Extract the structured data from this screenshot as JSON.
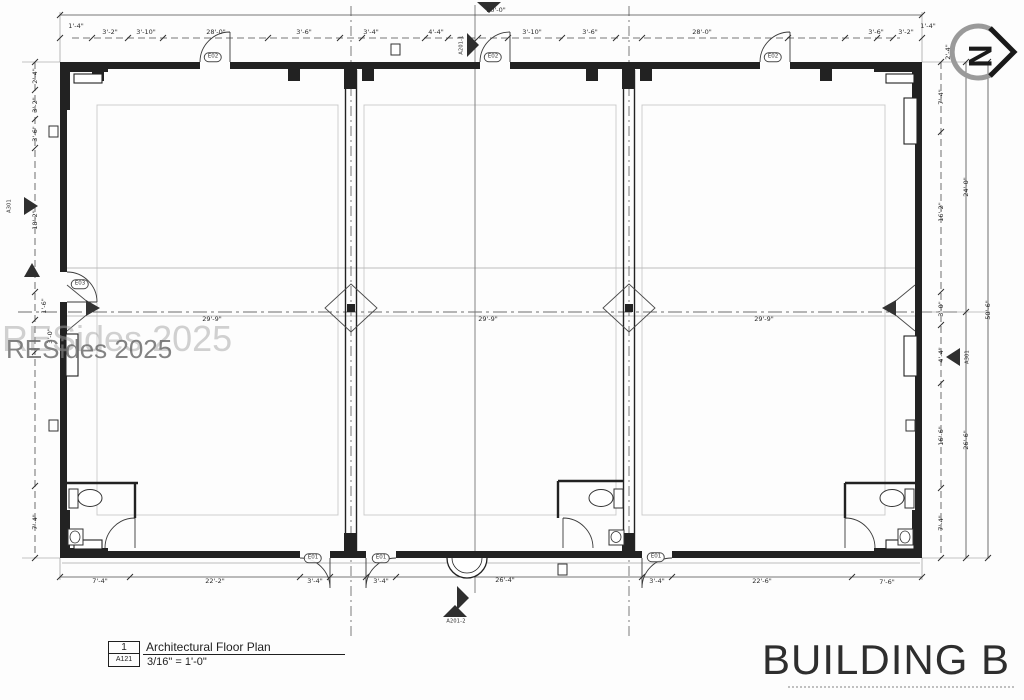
{
  "drawing": {
    "building_title": "BUILDING B",
    "watermark_text": "RESides 2025",
    "north_label": "N",
    "title_block": {
      "detail_number": "1",
      "sheet_number": "A121",
      "view_title": "Architectural Floor Plan",
      "scale": "3/16\" = 1'-0\""
    }
  },
  "labels": [
    {
      "t": "90'-0\"",
      "x": 496,
      "y": 10
    },
    {
      "t": "1'-4\"",
      "x": 76,
      "y": 26
    },
    {
      "t": "3'-2\"",
      "x": 110,
      "y": 32
    },
    {
      "t": "3'-10\"",
      "x": 146,
      "y": 32
    },
    {
      "t": "28'-0\"",
      "x": 216,
      "y": 32
    },
    {
      "t": "3'-6\"",
      "x": 304,
      "y": 32
    },
    {
      "t": "3'-4\"",
      "x": 371,
      "y": 32
    },
    {
      "t": "4'-4\"",
      "x": 436,
      "y": 32
    },
    {
      "t": "3'-10\"",
      "x": 532,
      "y": 32
    },
    {
      "t": "3'-6\"",
      "x": 590,
      "y": 32
    },
    {
      "t": "28'-0\"",
      "x": 702,
      "y": 32
    },
    {
      "t": "3'-6\"",
      "x": 876,
      "y": 32
    },
    {
      "t": "3'-2\"",
      "x": 906,
      "y": 32
    },
    {
      "t": "1'-4\"",
      "x": 928,
      "y": 26
    },
    {
      "t": "7'-4\"",
      "x": 100,
      "y": 581
    },
    {
      "t": "22'-2\"",
      "x": 215,
      "y": 581
    },
    {
      "t": "3'-4\"",
      "x": 315,
      "y": 581
    },
    {
      "t": "3'-4\"",
      "x": 381,
      "y": 581
    },
    {
      "t": "26'-4\"",
      "x": 505,
      "y": 580
    },
    {
      "t": "3'-4\"",
      "x": 657,
      "y": 581
    },
    {
      "t": "22'-6\"",
      "x": 762,
      "y": 581
    },
    {
      "t": "7'-6\"",
      "x": 887,
      "y": 582
    },
    {
      "t": "29'-9\"",
      "x": 212,
      "y": 319
    },
    {
      "t": "29'-9\"",
      "x": 488,
      "y": 319
    },
    {
      "t": "29'-9\"",
      "x": 764,
      "y": 319
    },
    {
      "t": "7'-4\"",
      "x": 941,
      "y": 97,
      "r": 1
    },
    {
      "t": "16'-2\"",
      "x": 941,
      "y": 212,
      "r": 1
    },
    {
      "t": "3'-0\"",
      "x": 941,
      "y": 309,
      "r": 1
    },
    {
      "t": "4'-4\"",
      "x": 941,
      "y": 355,
      "r": 1
    },
    {
      "t": "16'-6\"",
      "x": 941,
      "y": 436,
      "r": 1
    },
    {
      "t": "7'-4\"",
      "x": 941,
      "y": 523,
      "r": 1
    },
    {
      "t": "24'-0\"",
      "x": 966,
      "y": 187,
      "r": 1
    },
    {
      "t": "26'-6\"",
      "x": 966,
      "y": 440,
      "r": 1
    },
    {
      "t": "50'-6\"",
      "x": 988,
      "y": 310,
      "r": 1
    },
    {
      "t": "2'-4\"",
      "x": 948,
      "y": 52,
      "r": 1
    },
    {
      "t": "2'-4\"",
      "x": 35,
      "y": 76,
      "r": 1
    },
    {
      "t": "3'-2\"",
      "x": 35,
      "y": 105,
      "r": 1
    },
    {
      "t": "3'-6\"",
      "x": 35,
      "y": 134,
      "r": 1
    },
    {
      "t": "18'-2\"",
      "x": 35,
      "y": 220,
      "r": 1
    },
    {
      "t": "1'-6\"",
      "x": 44,
      "y": 306,
      "r": 1
    },
    {
      "t": "3'-0\"",
      "x": 50,
      "y": 336,
      "r": 1
    },
    {
      "t": "7'-4\"",
      "x": 35,
      "y": 522,
      "r": 1
    },
    {
      "t": "E02",
      "x": 213,
      "y": 57,
      "cls": "tag",
      "n": "door-tag"
    },
    {
      "t": "E02",
      "x": 493,
      "y": 57,
      "cls": "tag",
      "n": "door-tag"
    },
    {
      "t": "E02",
      "x": 773,
      "y": 57,
      "cls": "tag",
      "n": "door-tag"
    },
    {
      "t": "E01",
      "x": 313,
      "y": 558,
      "cls": "tag",
      "n": "door-tag"
    },
    {
      "t": "E01",
      "x": 381,
      "y": 558,
      "cls": "tag",
      "n": "door-tag"
    },
    {
      "t": "E01",
      "x": 656,
      "y": 557,
      "cls": "tag",
      "n": "door-tag"
    },
    {
      "t": "E03",
      "x": 80,
      "y": 284,
      "cls": "tag",
      "n": "door-tag"
    },
    {
      "t": "A201-1",
      "x": 462,
      "y": 45,
      "r": 1,
      "cls": "mk",
      "n": "section-ref-label"
    },
    {
      "t": "A201-2",
      "x": 456,
      "y": 622,
      "cls": "mk",
      "n": "section-ref-label"
    },
    {
      "t": "A301",
      "x": 10,
      "y": 206,
      "r": 1,
      "cls": "mk",
      "n": "elevation-ref-label"
    },
    {
      "t": "A301",
      "x": 968,
      "y": 357,
      "r": 1,
      "cls": "mk",
      "n": "elevation-ref-label"
    }
  ]
}
